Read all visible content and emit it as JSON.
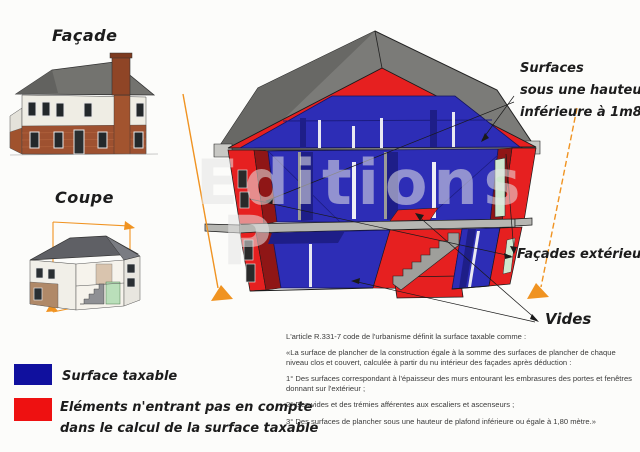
{
  "document": {
    "topic": "Surface taxable - coupe de maison",
    "language": "fr"
  },
  "panels": {
    "facade": {
      "title": "Façade"
    },
    "coupe": {
      "title": "Coupe"
    }
  },
  "watermark": {
    "line1": "Editions",
    "line2": "P"
  },
  "annotations": {
    "surfaces_line1": "Surfaces",
    "surfaces_line2": "sous une hauteur",
    "surfaces_line3": "inférieure à 1m80",
    "facades": "Façades extérieures",
    "vides": "Vides"
  },
  "legend": {
    "taxable": {
      "label": "Surface taxable"
    },
    "non_taxable": {
      "label_line1": "Eléments n'entrant pas en compte",
      "label_line2": "dans le calcul de la surface taxable"
    }
  },
  "legal": {
    "paragraphs": [
      "L'article R.331-7 code de l'urbanisme définit la surface taxable comme :",
      "«La surface de plancher de la construction égale à la somme des surfaces de plancher de chaque niveau clos et couvert, calculée à partir du nu intérieur des façades après déduction :",
      "1° Des surfaces correspondant à l'épaisseur des murs entourant les embrasures des portes et fenêtres donnant sur l'extérieur ;",
      "2° Des vides et des trémies afférentes aux escaliers et ascenseurs ;",
      "3° Des surfaces de plancher sous une hauteur de plafond inférieure ou égale à 1,80 mètre.»"
    ]
  },
  "colors": {
    "taxable": "#2d2db6",
    "navy": "#1e1e88",
    "nontaxable": "#e62020",
    "reddark": "#8f1616",
    "roof": "#7b7b78",
    "roofdark": "#686865",
    "slab": "#b6b6b2",
    "stair": "#9f9f9b",
    "orange": "#f09321",
    "green": "#cfe7cf",
    "ink": "#1a1a1a",
    "legend_taxable": "#10109e",
    "legend_nontaxable": "#ee1111"
  }
}
